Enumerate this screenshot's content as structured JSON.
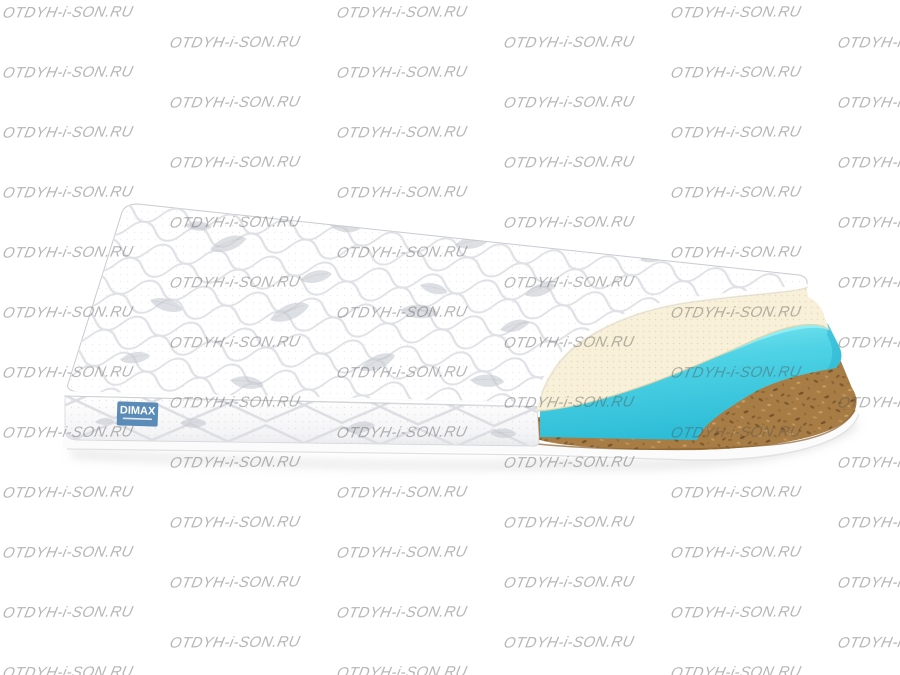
{
  "watermark": {
    "text": "OTDYH-i-SON.RU",
    "color": "rgba(80,80,80,0.42)",
    "font_size_px": 15,
    "column_x": [
      3,
      170,
      337,
      504,
      671,
      838
    ],
    "even_col_y_start": 5,
    "odd_col_y_start": 35,
    "row_spacing": 60,
    "canvas_height": 675
  },
  "product": {
    "brand_label": {
      "text": "DIMAX",
      "bg_color": "#5b8cb8",
      "text_color": "#ffffff"
    },
    "layers": [
      {
        "name": "quilted-top-cover",
        "color": "#ffffff"
      },
      {
        "name": "latex-layer",
        "color": "#f8f0d8"
      },
      {
        "name": "foam-layer",
        "color": "#4ed2e5"
      },
      {
        "name": "coir-layer",
        "color": "#a87c45"
      },
      {
        "name": "base-bottom-cover",
        "color": "#fbfbfb"
      }
    ]
  }
}
